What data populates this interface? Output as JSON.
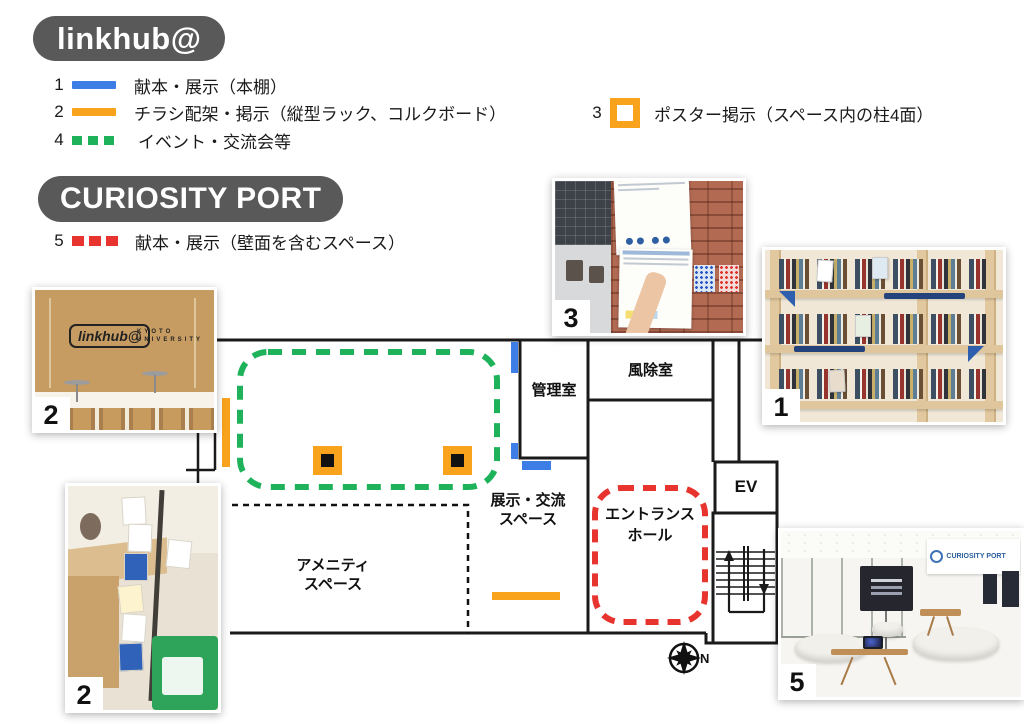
{
  "badges": {
    "linkhub": "linkhub@",
    "curiosity": "CURIOSITY PORT"
  },
  "legend": {
    "items_linkhub": [
      {
        "num": "1",
        "label": "献本・展示（本棚）"
      },
      {
        "num": "2",
        "label": "チラシ配架・掲示（縦型ラック、コルクボード）"
      },
      {
        "num": "4",
        "label": "イベント・交流会等"
      }
    ],
    "item_poster": {
      "num": "3",
      "label": "ポスター掲示（スペース内の柱4面）"
    },
    "items_curiosity": [
      {
        "num": "5",
        "label": "献本・展示（壁面を含むスペース）"
      }
    ]
  },
  "plan": {
    "rooms": {
      "kanri": {
        "label": "管理室"
      },
      "fujo": {
        "label": "風除室"
      },
      "tenji": {
        "line1": "展示・交流",
        "line2": "スペース"
      },
      "amenity": {
        "line1": "アメニティ",
        "line2": "スペース"
      },
      "entrance": {
        "line1": "エントランス",
        "line2": "ホール"
      },
      "ev": {
        "label": "EV"
      }
    },
    "compass": {
      "label": "N"
    }
  },
  "photos": {
    "p2_top": {
      "num": "2",
      "sign_line1": "linkhub@",
      "sign_line2": "KYOTO",
      "sign_line3": "UNIVERSITY"
    },
    "p2_bottom": {
      "num": "2"
    },
    "p3": {
      "num": "3"
    },
    "p1": {
      "num": "1"
    },
    "p5": {
      "num": "5",
      "banner": "CURIOSITY PORT"
    }
  },
  "colors": {
    "blue": "#3c7de6",
    "orange": "#f9a21b",
    "green": "#1eb35a",
    "red": "#e8342e",
    "badge_bg": "#595959",
    "wall": "#1a1a1a"
  }
}
